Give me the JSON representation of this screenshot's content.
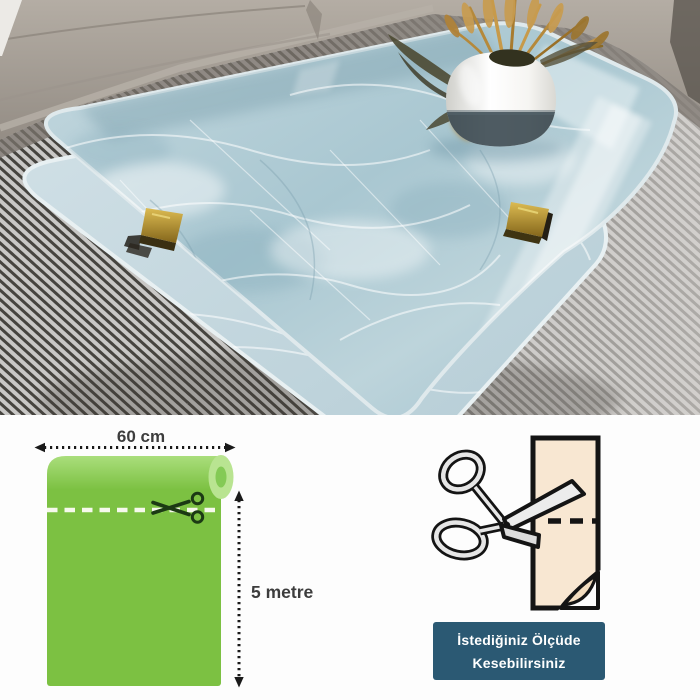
{
  "size_diagram": {
    "width_label": "60 cm",
    "height_label": "5 metre"
  },
  "cut_note": {
    "line1": "İstediğiniz Ölçüde",
    "line2": "Kesebilirsiniz"
  },
  "palette": {
    "roll_green": "#7cc142",
    "roll_green_light": "#b9e491",
    "cut_line_white": "#f6f9ec",
    "arrow_black": "#1a1a1a",
    "label_text": "#3d3d3d",
    "badge_bg": "#2b5973",
    "badge_text": "#ffffff",
    "paper_beige": "#f8e7d2",
    "outline_black": "#141414",
    "marble_blue": "#b7cfd9",
    "sofa_gray": "#a29b93",
    "rug_gray": "#b5b3b0",
    "clip_gold": "#c2a03d",
    "vase_white": "#ffffff",
    "wheat_tan": "#c0924a"
  }
}
